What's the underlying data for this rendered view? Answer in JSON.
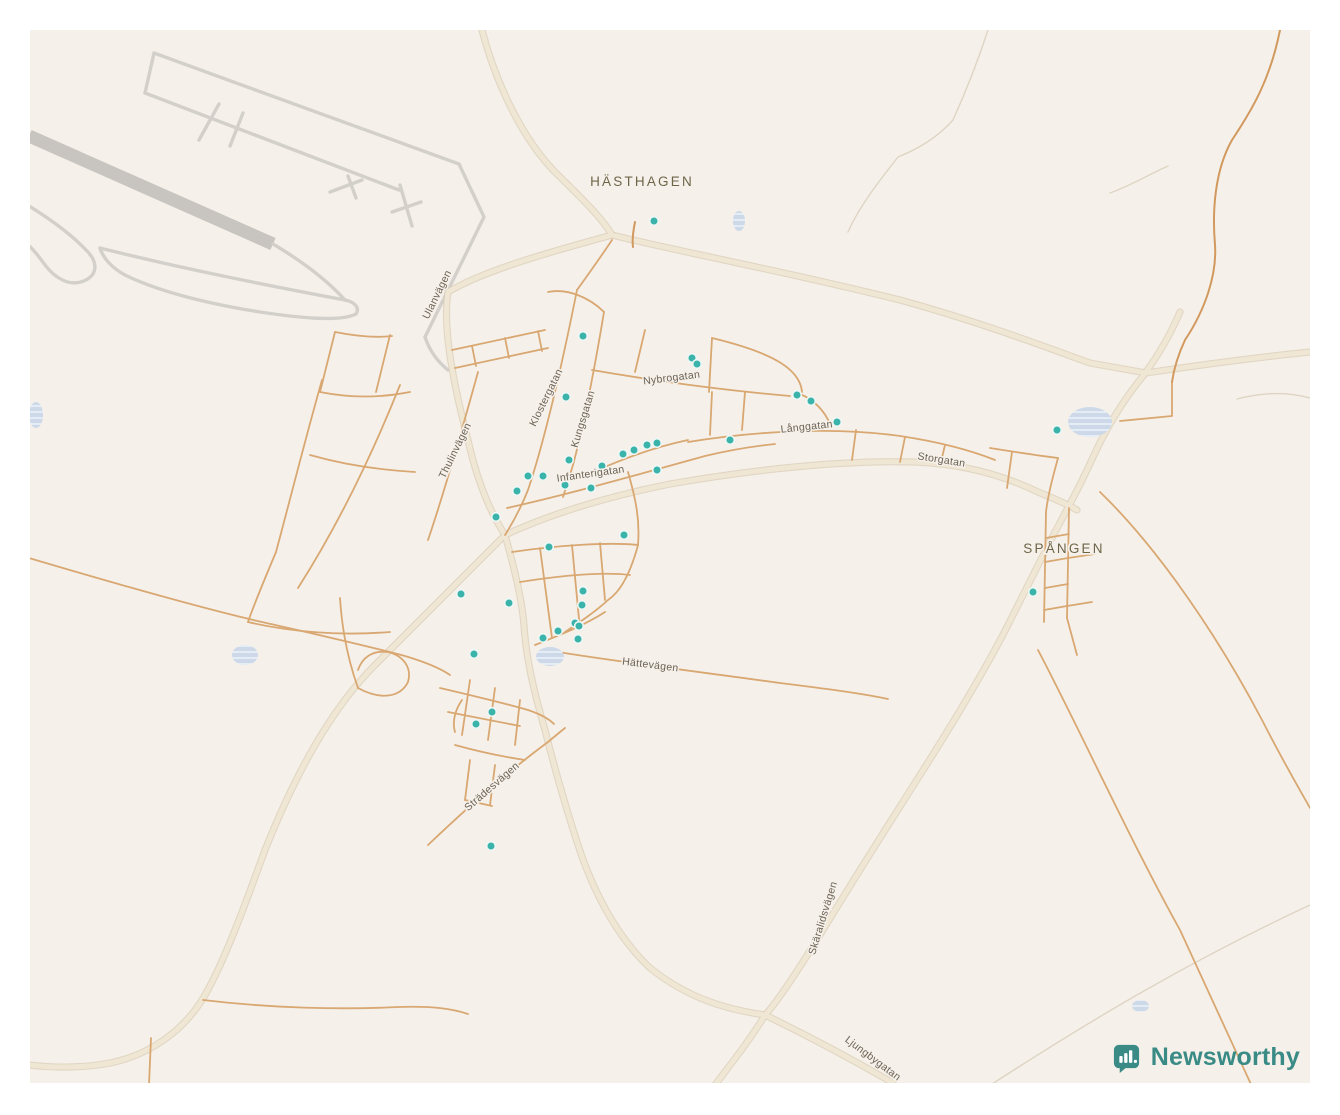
{
  "page": {
    "background": "#ffffff",
    "map_background": "#f5f1ea"
  },
  "branding": {
    "logo_text": "Newsworthy",
    "logo_color": "#3a8a86",
    "logo_icon": "bar-chart-speech-bubble"
  },
  "map": {
    "place_labels": [
      {
        "label": "HÄSTHAGEN",
        "x": 642,
        "y": 186,
        "rotation": 0
      },
      {
        "label": "SPÅNGEN",
        "x": 1064,
        "y": 553,
        "rotation": 0
      }
    ],
    "street_labels": [
      {
        "label": "Ulanvägen",
        "x": 440,
        "y": 296,
        "rotation": -64
      },
      {
        "label": "Thulinvägen",
        "x": 458,
        "y": 452,
        "rotation": -64
      },
      {
        "label": "Klostergatan",
        "x": 549,
        "y": 399,
        "rotation": -64
      },
      {
        "label": "Kungsgatan",
        "x": 586,
        "y": 420,
        "rotation": -73
      },
      {
        "label": "Nybrogatan",
        "x": 672,
        "y": 381,
        "rotation": -7
      },
      {
        "label": "Långgatan",
        "x": 807,
        "y": 430,
        "rotation": -6
      },
      {
        "label": "Storgatan",
        "x": 941,
        "y": 463,
        "rotation": 9
      },
      {
        "label": "Infanterigatan",
        "x": 591,
        "y": 477,
        "rotation": -8
      },
      {
        "label": "Hättevägen",
        "x": 650,
        "y": 668,
        "rotation": 7
      },
      {
        "label": "Strädesvägen",
        "x": 494,
        "y": 789,
        "rotation": -41
      },
      {
        "label": "Skäralidsvägen",
        "x": 826,
        "y": 919,
        "rotation": -73
      },
      {
        "label": "Ljungbygatan",
        "x": 871,
        "y": 1061,
        "rotation": 37
      }
    ],
    "markers": {
      "color": "#3ab3aa",
      "halo": "#eef7f5",
      "radius": 4.3,
      "points": [
        [
          654,
          221
        ],
        [
          583,
          336
        ],
        [
          566,
          397
        ],
        [
          692,
          358
        ],
        [
          697,
          364
        ],
        [
          797,
          395
        ],
        [
          811,
          401
        ],
        [
          837,
          422
        ],
        [
          730,
          440
        ],
        [
          1057,
          430
        ],
        [
          1033,
          592
        ],
        [
          623,
          454
        ],
        [
          634,
          450
        ],
        [
          647,
          445
        ],
        [
          657,
          443
        ],
        [
          657,
          470
        ],
        [
          602,
          466
        ],
        [
          569,
          460
        ],
        [
          565,
          485
        ],
        [
          591,
          488
        ],
        [
          528,
          476
        ],
        [
          543,
          476
        ],
        [
          517,
          491
        ],
        [
          496,
          517
        ],
        [
          549,
          547
        ],
        [
          624,
          535
        ],
        [
          583,
          591
        ],
        [
          582,
          605
        ],
        [
          575,
          623
        ],
        [
          579,
          626
        ],
        [
          558,
          631
        ],
        [
          543,
          638
        ],
        [
          578,
          639
        ],
        [
          461,
          594
        ],
        [
          509,
          603
        ],
        [
          474,
          654
        ],
        [
          492,
          712
        ],
        [
          476,
          724
        ],
        [
          491,
          846
        ]
      ]
    },
    "water_features": [
      {
        "x": 733,
        "y": 211,
        "w": 12,
        "h": 20
      },
      {
        "x": 1068,
        "y": 407,
        "w": 44,
        "h": 30
      },
      {
        "x": 29,
        "y": 402,
        "w": 14,
        "h": 26
      },
      {
        "x": 232,
        "y": 645,
        "w": 26,
        "h": 20
      },
      {
        "x": 536,
        "y": 647,
        "w": 28,
        "h": 19
      },
      {
        "x": 1132,
        "y": 1000,
        "w": 17,
        "h": 12
      }
    ],
    "water_color": "#cdd9e9"
  }
}
